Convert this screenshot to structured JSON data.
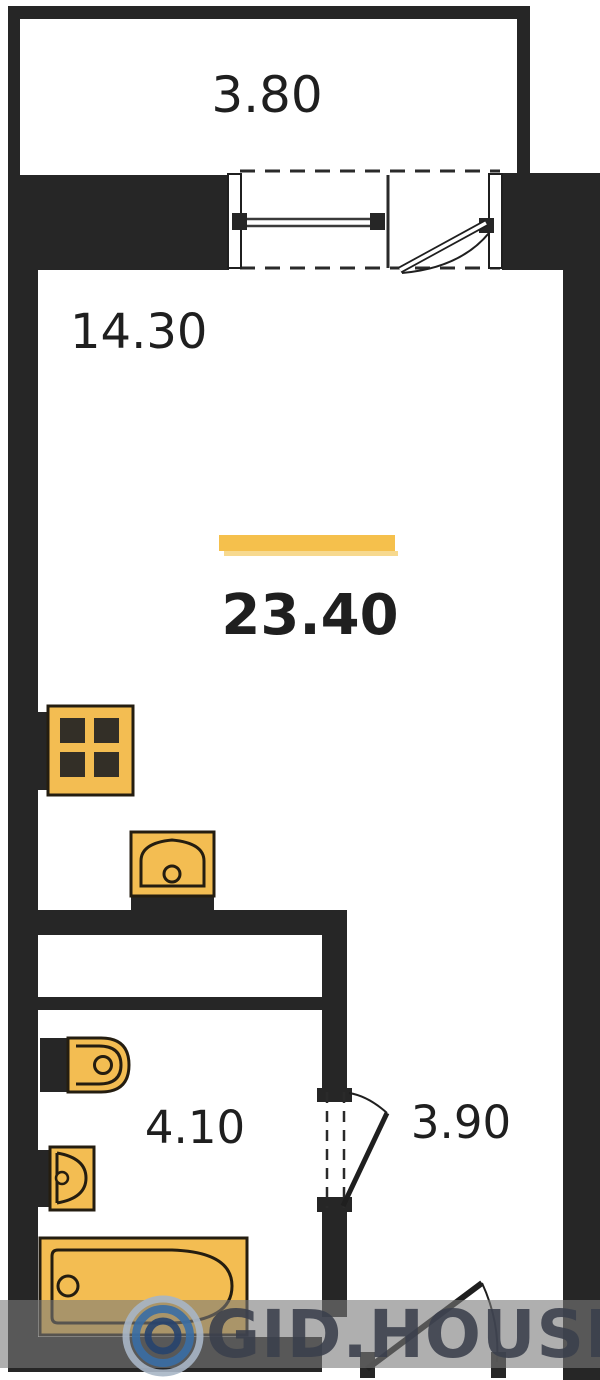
{
  "labels": {
    "balcony_area": "3.80",
    "room_area": "14.30",
    "total_area": "23.40",
    "bathroom_area": "4.10",
    "hall_area": "3.90"
  },
  "watermark": {
    "brand": "GID.HOUSE"
  },
  "colors": {
    "wall": "#262626",
    "fixture_fill": "#F3BD52",
    "fixture_outline": "#241d10",
    "area_highlight_bar": "#F5C04C",
    "label_text": "#1f1f1f",
    "watermark_band": "#7a7a7a",
    "watermark_text": "#3a3f4c",
    "logo_blue": "#3a6ea5"
  },
  "fixtures": [
    "stove",
    "kitchen-sink",
    "toilet",
    "washbasin",
    "bathtub"
  ],
  "openings": [
    "balcony-window",
    "balcony-door",
    "bathroom-door",
    "entry-door"
  ]
}
